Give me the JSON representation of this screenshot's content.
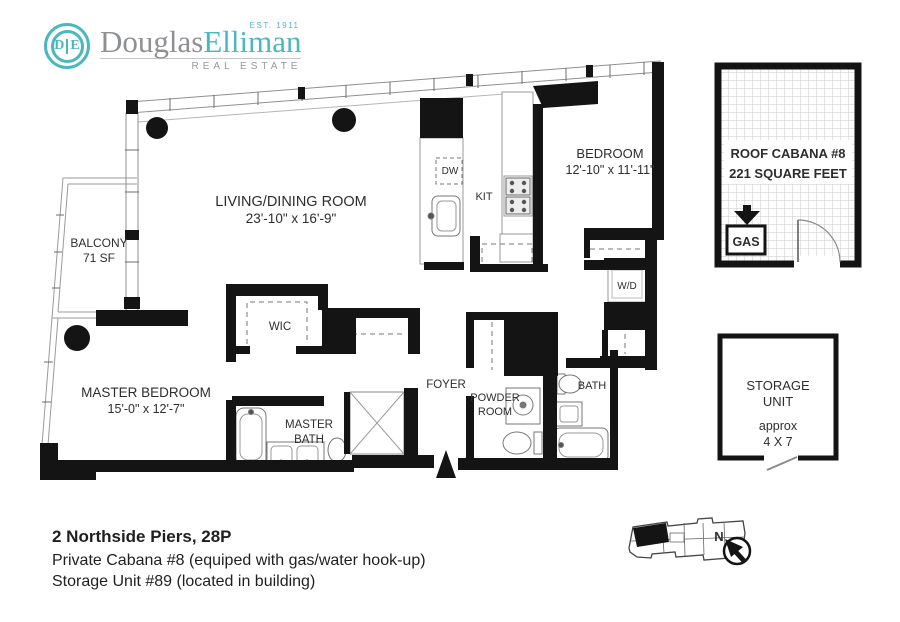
{
  "logo": {
    "monogram_left": "D",
    "monogram_right": "E",
    "brand_first": "Douglas",
    "brand_second": "Elliman",
    "est": "EST. 1911",
    "tagline": "REAL ESTATE"
  },
  "colors": {
    "teal": "#4bb8bf",
    "wall": "#141414",
    "label": "#2d2d2d"
  },
  "rooms": {
    "living": {
      "name": "LIVING/DINING ROOM",
      "dims": "23'-10\" x 16'-9\""
    },
    "bedroom": {
      "name": "BEDROOM",
      "dims": "12'-10\" x 11'-11\""
    },
    "master_bedroom": {
      "name": "MASTER BEDROOM",
      "dims": "15'-0\" x 12'-7\""
    },
    "balcony": {
      "name": "BALCONY",
      "dims": "71 SF"
    },
    "wic": {
      "name": "WIC"
    },
    "master_bath": {
      "line1": "MASTER",
      "line2": "BATH"
    },
    "foyer": {
      "name": "FOYER"
    },
    "powder": {
      "line1": "POWDER",
      "line2": "ROOM"
    },
    "bath": {
      "name": "BATH"
    },
    "wd": {
      "name": "W/D"
    },
    "kit": {
      "name": "KIT"
    },
    "dw": {
      "name": "DW"
    }
  },
  "cabana": {
    "line1": "ROOF CABANA #8",
    "line2": "221 SQUARE FEET",
    "gas": "GAS"
  },
  "storage": {
    "line1": "STORAGE",
    "line2": "UNIT",
    "line3": "approx",
    "line4": "4 X 7"
  },
  "compass": {
    "north": "N"
  },
  "footer": {
    "title": "2 Northside Piers, 28P",
    "line2": "Private Cabana #8 (equiped with gas/water hook-up)",
    "line3": "Storage Unit #89 (located in building)"
  }
}
